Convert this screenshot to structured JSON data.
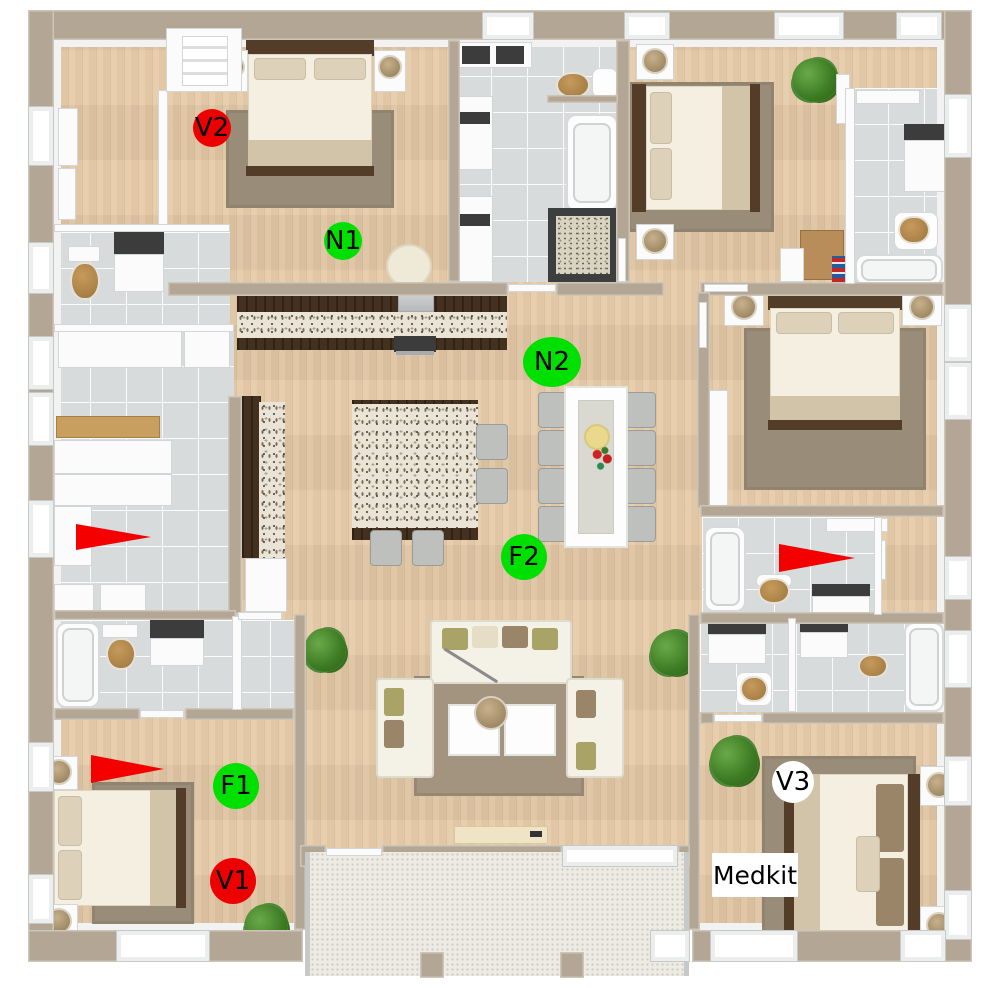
{
  "overlay": {
    "markers": [
      {
        "id": "V2",
        "label": "V2",
        "shape": "circle",
        "fill": "#ed0000",
        "text_color": "#000000",
        "x": 212,
        "y": 128,
        "rx": 19,
        "ry": 19
      },
      {
        "id": "N1",
        "label": "N1",
        "shape": "circle",
        "fill": "#00e000",
        "text_color": "#000000",
        "x": 343,
        "y": 241,
        "rx": 19,
        "ry": 19
      },
      {
        "id": "N2",
        "label": "N2",
        "shape": "ellipse",
        "fill": "#00e000",
        "text_color": "#000000",
        "x": 552,
        "y": 362,
        "rx": 29,
        "ry": 25
      },
      {
        "id": "F2",
        "label": "F2",
        "shape": "circle",
        "fill": "#00e000",
        "text_color": "#000000",
        "x": 524,
        "y": 557,
        "rx": 23,
        "ry": 23
      },
      {
        "id": "F1",
        "label": "F1",
        "shape": "circle",
        "fill": "#00e000",
        "text_color": "#000000",
        "x": 236,
        "y": 786,
        "rx": 23,
        "ry": 23
      },
      {
        "id": "V1",
        "label": "V1",
        "shape": "circle",
        "fill": "#ed0000",
        "text_color": "#000000",
        "x": 233,
        "y": 881,
        "rx": 23,
        "ry": 23
      },
      {
        "id": "V3",
        "label": "V3",
        "shape": "circle",
        "fill": "#ffffff",
        "text_color": "#000000",
        "x": 793,
        "y": 782,
        "rx": 21,
        "ry": 21
      }
    ],
    "floor_labels": [
      {
        "id": "medkit",
        "text": "Medkit",
        "bg": "#ffffff",
        "text_color": "#000000",
        "x": 712,
        "y": 853,
        "w": 86,
        "h": 44
      }
    ],
    "arrows": [
      {
        "id": "arrow-utility",
        "color": "#f40000",
        "direction": "right",
        "x": 76,
        "y": 524,
        "w": 75,
        "h": 27
      },
      {
        "id": "arrow-bath-right",
        "color": "#f40000",
        "direction": "right",
        "x": 779,
        "y": 544,
        "w": 76,
        "h": 28
      },
      {
        "id": "arrow-bedroom-bl",
        "color": "#f40000",
        "direction": "right",
        "x": 91,
        "y": 755,
        "w": 73,
        "h": 28
      }
    ]
  }
}
